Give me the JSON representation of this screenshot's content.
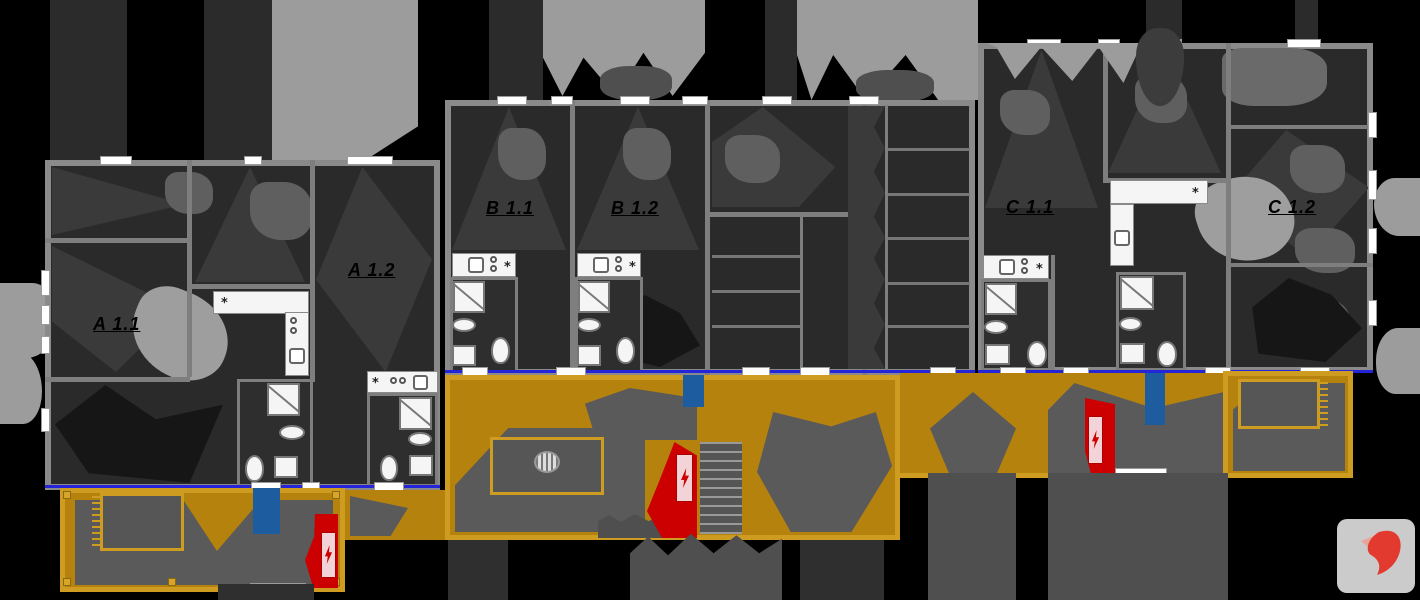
{
  "title": "Apartment building ground floor plan",
  "units": [
    {
      "label": "A 1.1"
    },
    {
      "label": "A 1.2"
    },
    {
      "label": "B 1.1"
    },
    {
      "label": "B 1.2"
    },
    {
      "label": "C 1.1"
    },
    {
      "label": "C 1.2"
    }
  ],
  "icons": {
    "kitchen_vent": "*"
  },
  "colors": {
    "background": "#000000",
    "wall": "#8a8a8a",
    "room": "#2a2a2a",
    "room_shade": "#3a3a3a",
    "furniture_dark": "#161616",
    "furniture_mid": "#5f5f5f",
    "furniture_light": "#9e9e9e",
    "fixture_white": "#f5f5f5",
    "terrace": "#b5820e",
    "terrace_frame": "#cf9c22",
    "terrace_shadow": "#5a5a5a",
    "electric_red": "#cc0000",
    "panel_pink": "#f2d4d8",
    "door_blue": "#1d5c9e",
    "facade_blue": "#2424d8",
    "canopy_gray": "#9c9c9c",
    "hedge_dark": "#2b2b2b",
    "tree_gray": "#4f4f4f",
    "logo_bg": "#cbcbcb",
    "logo_red": "#e23a2e"
  }
}
